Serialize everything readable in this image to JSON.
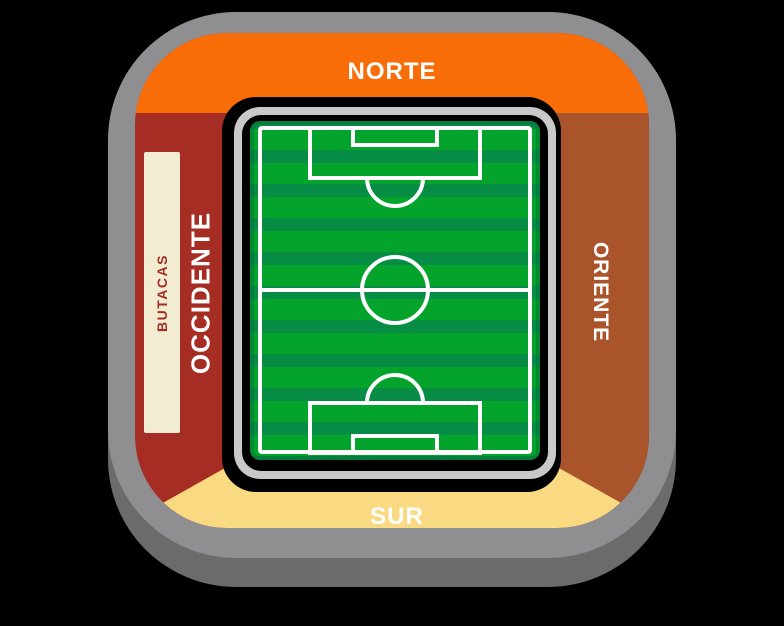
{
  "map": {
    "type": "stadium-seating-map",
    "venue_shape": "rounded-bowl"
  },
  "sections": {
    "norte": {
      "label": "NORTE",
      "color": "#F96D09",
      "text_color": "#FFFFFF"
    },
    "sur": {
      "label": "SUR",
      "color": "#F9D981",
      "text_color": "#FFFFFF"
    },
    "occidente": {
      "label": "OCCIDENTE",
      "color": "#A52D23",
      "text_color": "#FFFFFF"
    },
    "oriente": {
      "label": "ORIENTE",
      "color": "#A9542A",
      "text_color": "#FFFFFF"
    },
    "butacas": {
      "label": "BUTACAS",
      "color": "#F1ECD2",
      "text_color": "#A52D23"
    }
  },
  "field": {
    "icon": "soccer-field-icon",
    "grass_light": "#04A42C",
    "grass_dark": "#078C45",
    "line_color": "#FFFFFF",
    "frame_color": "#C9C9C9"
  },
  "structure": {
    "bowl_color": "#8F8F92",
    "shadow_color": "#6B6B6B",
    "gap_color": "#000000",
    "background": "#000000"
  }
}
